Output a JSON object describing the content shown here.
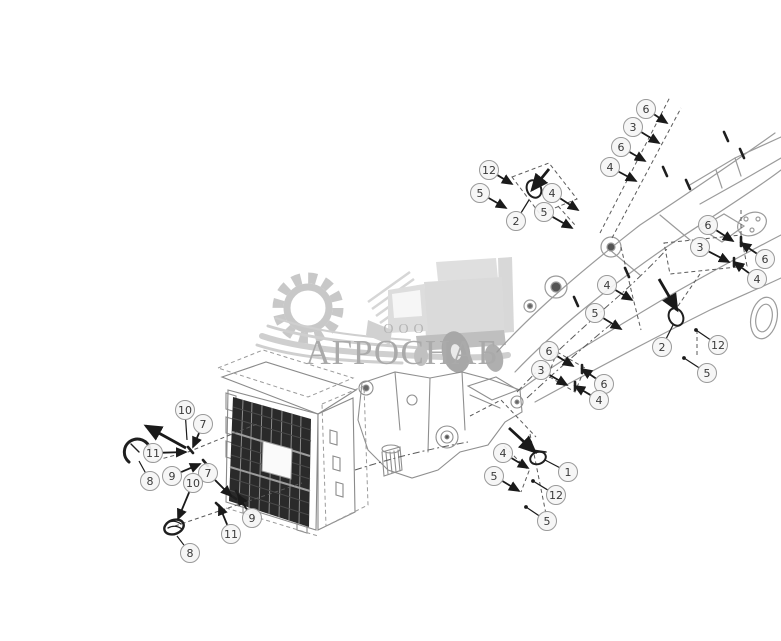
{
  "watermark": {
    "org_type": "ООО",
    "name": "АГРОСНАБ",
    "text_color": "#a6a6a6",
    "small_text_color": "#b2b2b2",
    "art_color": "#cccccc"
  },
  "diagram": {
    "type": "exploded-parts-diagram",
    "background": "#ffffff",
    "ghost_line_color": "#9b9b9b",
    "part_line_color": "#1f1f1f",
    "leader_color": "#1a1a1a",
    "balloon_fill": "#f5f5f5",
    "balloon_stroke": "#9a9a9a",
    "balloon_text_color": "#3a3a3a",
    "callouts": [
      {
        "label": "6",
        "x": 646,
        "y": 109,
        "tx": 667,
        "ty": 123,
        "end": "arrow"
      },
      {
        "label": "3",
        "x": 633,
        "y": 127,
        "tx": 659,
        "ty": 143,
        "end": "arrow"
      },
      {
        "label": "6",
        "x": 621,
        "y": 147,
        "tx": 645,
        "ty": 161,
        "end": "arrow"
      },
      {
        "label": "4",
        "x": 610,
        "y": 167,
        "tx": 636,
        "ty": 181,
        "end": "arrow"
      },
      {
        "label": "12",
        "x": 489,
        "y": 170,
        "tx": 512,
        "ty": 184,
        "end": "arrow"
      },
      {
        "label": "5",
        "x": 480,
        "y": 193,
        "tx": 506,
        "ty": 208,
        "end": "arrow"
      },
      {
        "label": "4",
        "x": 552,
        "y": 193,
        "tx": 578,
        "ty": 210,
        "end": "arrow"
      },
      {
        "label": "5",
        "x": 544,
        "y": 212,
        "tx": 572,
        "ty": 228,
        "end": "arrow"
      },
      {
        "label": "2",
        "x": 516,
        "y": 221,
        "tx": 529,
        "ty": 200,
        "end": "none"
      },
      {
        "label": "6",
        "x": 708,
        "y": 225,
        "tx": 733,
        "ty": 241,
        "end": "arrow"
      },
      {
        "label": "3",
        "x": 700,
        "y": 247,
        "tx": 729,
        "ty": 262,
        "end": "arrow"
      },
      {
        "label": "6",
        "x": 765,
        "y": 259,
        "tx": 741,
        "ty": 243,
        "end": "arrow"
      },
      {
        "label": "4",
        "x": 757,
        "y": 279,
        "tx": 734,
        "ty": 262,
        "end": "arrow"
      },
      {
        "label": "4",
        "x": 607,
        "y": 285,
        "tx": 632,
        "ty": 300,
        "end": "arrow"
      },
      {
        "label": "5",
        "x": 595,
        "y": 313,
        "tx": 621,
        "ty": 329,
        "end": "arrow"
      },
      {
        "label": "2",
        "x": 662,
        "y": 347,
        "tx": 673,
        "ty": 325,
        "end": "none"
      },
      {
        "label": "12",
        "x": 718,
        "y": 345,
        "tx": 696,
        "ty": 330,
        "end": "dot"
      },
      {
        "label": "5",
        "x": 707,
        "y": 373,
        "tx": 684,
        "ty": 358,
        "end": "dot"
      },
      {
        "label": "6",
        "x": 549,
        "y": 351,
        "tx": 573,
        "ty": 366,
        "end": "arrow"
      },
      {
        "label": "3",
        "x": 541,
        "y": 370,
        "tx": 567,
        "ty": 385,
        "end": "arrow"
      },
      {
        "label": "6",
        "x": 604,
        "y": 384,
        "tx": 582,
        "ty": 369,
        "end": "arrow"
      },
      {
        "label": "4",
        "x": 599,
        "y": 400,
        "tx": 575,
        "ty": 386,
        "end": "arrow"
      },
      {
        "label": "10",
        "x": 185,
        "y": 410,
        "tx": 187,
        "ty": 440,
        "end": "none"
      },
      {
        "label": "7",
        "x": 203,
        "y": 424,
        "tx": 193,
        "ty": 447,
        "end": "arrow"
      },
      {
        "label": "11",
        "x": 153,
        "y": 453,
        "tx": 186,
        "ty": 452,
        "end": "arrow"
      },
      {
        "label": "9",
        "x": 172,
        "y": 476,
        "tx": 200,
        "ty": 464,
        "end": "arrow"
      },
      {
        "label": "8",
        "x": 150,
        "y": 481,
        "tx": 139,
        "ty": 461,
        "end": "none"
      },
      {
        "label": "7",
        "x": 208,
        "y": 473,
        "tx": 231,
        "ty": 496,
        "end": "arrow"
      },
      {
        "label": "10",
        "x": 193,
        "y": 483,
        "tx": 178,
        "ty": 519,
        "end": "arrow"
      },
      {
        "label": "9",
        "x": 252,
        "y": 518,
        "tx": 238,
        "ty": 495,
        "end": "arrow"
      },
      {
        "label": "11",
        "x": 231,
        "y": 534,
        "tx": 219,
        "ty": 505,
        "end": "arrow"
      },
      {
        "label": "8",
        "x": 190,
        "y": 553,
        "tx": 177,
        "ty": 536,
        "end": "none"
      },
      {
        "label": "4",
        "x": 503,
        "y": 453,
        "tx": 528,
        "ty": 468,
        "end": "arrow"
      },
      {
        "label": "5",
        "x": 494,
        "y": 476,
        "tx": 519,
        "ty": 491,
        "end": "arrow"
      },
      {
        "label": "1",
        "x": 568,
        "y": 472,
        "tx": 545,
        "ty": 460,
        "end": "none"
      },
      {
        "label": "12",
        "x": 556,
        "y": 495,
        "tx": 533,
        "ty": 481,
        "end": "dot"
      },
      {
        "label": "5",
        "x": 547,
        "y": 521,
        "tx": 526,
        "ty": 507,
        "end": "dot"
      }
    ],
    "extra_arrows": [
      {
        "x1": 509,
        "y1": 428,
        "x2": 535,
        "y2": 452
      },
      {
        "x1": 186,
        "y1": 448,
        "x2": 146,
        "y2": 426
      },
      {
        "x1": 549,
        "y1": 169,
        "x2": 532,
        "y2": 190
      },
      {
        "x1": 659,
        "y1": 279,
        "x2": 677,
        "y2": 310
      }
    ]
  }
}
